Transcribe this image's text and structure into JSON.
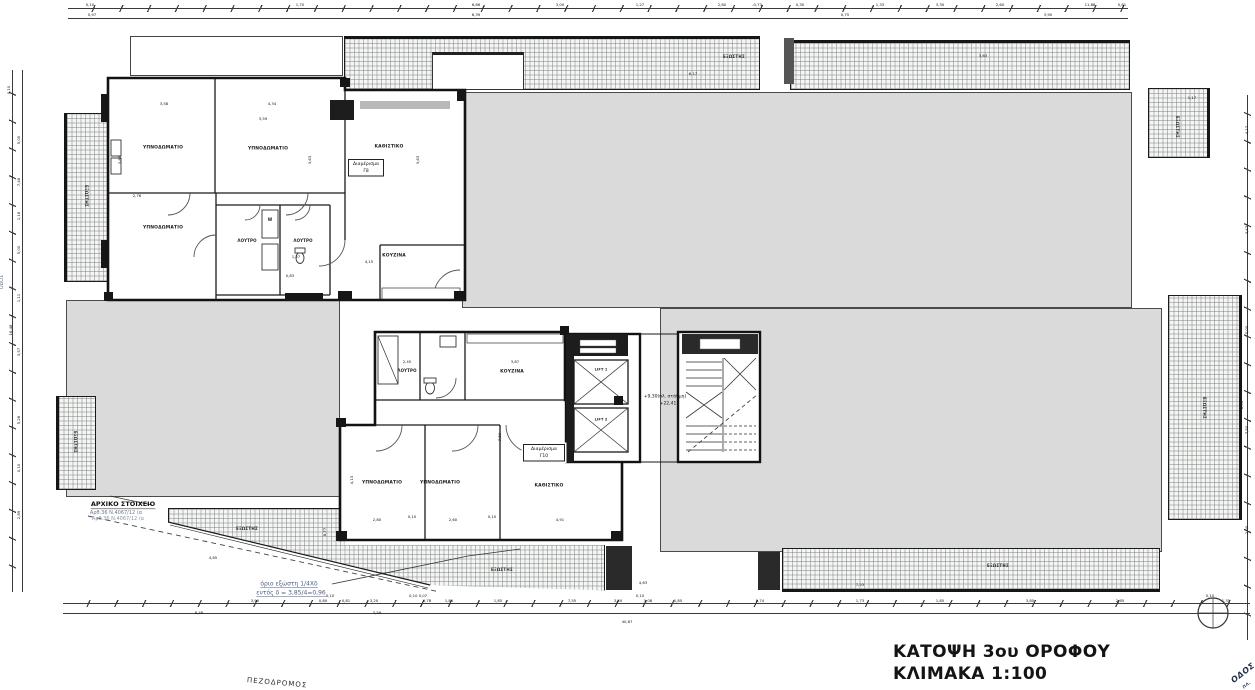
{
  "title": {
    "line1": "ΚΑΤΟΨΗ 3ου ΟΡΟΦΟΥ",
    "line2": "ΚΛΙΜΑΚΑ 1:100"
  },
  "apartment_tags": {
    "g8": {
      "label": "Διαμέρισμα",
      "unit": "Γ8"
    },
    "g10": {
      "label": "Διαμέρισμα",
      "unit": "Γ10"
    }
  },
  "colors": {
    "mass_fill": "#dadada",
    "hatch_line": "#8c9696",
    "note_blue": "#4a5f85",
    "line": "#1a1a1a"
  },
  "labels": [
    {
      "t": "ΥΠΝΟΔΩΜΑΤΙΟ",
      "x": 163,
      "y": 148,
      "s": 4.5,
      "c": "room",
      "n": "room-label-bedroom"
    },
    {
      "t": "ΥΠΝΟΔΩΜΑΤΙΟ",
      "x": 268,
      "y": 149,
      "s": 4.5,
      "c": "room",
      "n": "room-label-bedroom"
    },
    {
      "t": "ΚΑΘΙΣΤΙΚΟ",
      "x": 389,
      "y": 147,
      "s": 4.5,
      "c": "room",
      "n": "room-label-living"
    },
    {
      "t": "ΥΠΝΟΔΩΜΑΤΙΟ",
      "x": 163,
      "y": 228,
      "s": 4.5,
      "c": "room",
      "n": "room-label-bedroom"
    },
    {
      "t": "ΛΟΥΤΡΟ",
      "x": 247,
      "y": 241,
      "s": 4,
      "c": "room",
      "n": "room-label-bath"
    },
    {
      "t": "W",
      "x": 270,
      "y": 220,
      "s": 4,
      "c": "room",
      "n": "room-label-wc"
    },
    {
      "t": "ΛΟΥΤΡΟ",
      "x": 303,
      "y": 241,
      "s": 4,
      "c": "room",
      "n": "room-label-bath"
    },
    {
      "t": "ΚΟΥΖΙΝΑ",
      "x": 394,
      "y": 256,
      "s": 4.5,
      "c": "room",
      "n": "room-label-kitchen"
    },
    {
      "t": "ΛΟΥΤΡΟ",
      "x": 407,
      "y": 371,
      "s": 4,
      "c": "room",
      "n": "room-label-bath"
    },
    {
      "t": "ΚΟΥΖΙΝΑ",
      "x": 512,
      "y": 372,
      "s": 4.5,
      "c": "room",
      "n": "room-label-kitchen"
    },
    {
      "t": "ΥΠΝΟΔΩΜΑΤΙΟ",
      "x": 382,
      "y": 483,
      "s": 4.5,
      "c": "room",
      "n": "room-label-bedroom"
    },
    {
      "t": "ΥΠΝΟΔΩΜΑΤΙΟ",
      "x": 440,
      "y": 483,
      "s": 4.5,
      "c": "room",
      "n": "room-label-bedroom"
    },
    {
      "t": "ΚΑΘΙΣΤΙΚΟ",
      "x": 549,
      "y": 486,
      "s": 4.5,
      "c": "room",
      "n": "room-label-living"
    },
    {
      "t": "LIFT 1",
      "x": 601,
      "y": 370,
      "s": 3.5,
      "c": "room",
      "n": "lift-label"
    },
    {
      "t": "LIFT 2",
      "x": 601,
      "y": 420,
      "s": 3.5,
      "c": "room",
      "n": "lift-label"
    },
    {
      "t": "+9,30(πλ. στάθμη)",
      "x": 665,
      "y": 397,
      "s": 4.5,
      "c": "dim",
      "n": "level-label"
    },
    {
      "t": "+22,41",
      "x": 668,
      "y": 404,
      "s": 4.5,
      "c": "dim",
      "n": "level-label"
    },
    {
      "t": "ΕΞΩΣΤΗΣ",
      "x": 734,
      "y": 57,
      "s": 4,
      "c": "bal-l",
      "n": "balcony-label"
    },
    {
      "t": "ΕΞΩΣΤΗΣ",
      "x": 1177,
      "y": 127,
      "s": 4,
      "r": 90,
      "c": "bal-l",
      "n": "balcony-label"
    },
    {
      "t": "ΕΞΩΣΤΗΣ",
      "x": 1204,
      "y": 408,
      "s": 4,
      "r": 90,
      "c": "bal-l",
      "n": "balcony-label"
    },
    {
      "t": "ΕΞΩΣΤΗΣ",
      "x": 998,
      "y": 566,
      "s": 4,
      "c": "bal-l",
      "n": "balcony-label"
    },
    {
      "t": "ΕΞΩΣΤΗΣ",
      "x": 502,
      "y": 570,
      "s": 4,
      "c": "bal-l",
      "n": "balcony-label"
    },
    {
      "t": "ΕΞΩΣΤΗΣ",
      "x": 247,
      "y": 529,
      "s": 4,
      "c": "bal-l",
      "n": "balcony-label"
    },
    {
      "t": "ΕΞΩΣΤΗΣ",
      "x": 86,
      "y": 196,
      "s": 4,
      "r": 90,
      "c": "bal-l",
      "n": "balcony-label"
    },
    {
      "t": "ΕΞΩΣΤΗΣ",
      "x": 75,
      "y": 442,
      "s": 4,
      "r": 90,
      "c": "bal-l",
      "n": "balcony-label"
    },
    {
      "t": "ΑΡΧΙΚΟ ΣΤΟΙΧΕΙΟ",
      "x": 123,
      "y": 505,
      "s": 6.5,
      "c": "note-strong",
      "n": "note-initial-element"
    },
    {
      "t": "Αρθ.36 Ν.4067/12 (α",
      "x": 116,
      "y": 513,
      "s": 5,
      "c": "note-gray",
      "n": "note-regulation"
    },
    {
      "t": "Αρθ.36 Ν.4067/12 (α",
      "x": 118,
      "y": 519,
      "s": 5,
      "c": "note-gray2",
      "n": "note-regulation"
    },
    {
      "t": "όριο εξώστη 1/4Χδ",
      "x": 289,
      "y": 584,
      "s": 6,
      "c": "note-blue",
      "n": "note-balcony-limit"
    },
    {
      "t": "εντός δ = 3,85/4=0,96",
      "x": 291,
      "y": 593,
      "s": 6,
      "c": "note-blue",
      "n": "note-balcony-limit"
    },
    {
      "t": "ΠΕΖΟΔΡΟΜΟΣ",
      "x": 277,
      "y": 683,
      "s": 7,
      "r": 5,
      "c": "street",
      "n": "street-label-pedestrian"
    },
    {
      "t": "ΟΔΟΣ",
      "x": 1243,
      "y": 673,
      "s": 8,
      "r": -38,
      "c": "street-diag",
      "n": "street-label-road"
    },
    {
      "t": "ΠΛ.",
      "x": 1247,
      "y": 685,
      "s": 4,
      "r": -38,
      "c": "street-diag",
      "n": "street-label-road"
    },
    {
      "t": "ΟΔΟΣ",
      "x": 2,
      "y": 282,
      "s": 5,
      "r": -90,
      "c": "note-gray",
      "n": "street-label-side"
    },
    {
      "t": "0,10",
      "x": 90,
      "y": 5,
      "s": 3.8,
      "c": "dim",
      "n": "dim"
    },
    {
      "t": "1,70",
      "x": 300,
      "y": 5,
      "s": 3.8,
      "c": "dim",
      "n": "dim"
    },
    {
      "t": "6,86",
      "x": 476,
      "y": 5,
      "s": 3.8,
      "c": "dim",
      "n": "dim"
    },
    {
      "t": "3,00",
      "x": 560,
      "y": 5,
      "s": 3.8,
      "c": "dim",
      "n": "dim"
    },
    {
      "t": "1,27",
      "x": 640,
      "y": 5,
      "s": 3.8,
      "c": "dim",
      "n": "dim"
    },
    {
      "t": "2,60",
      "x": 722,
      "y": 5,
      "s": 3.8,
      "c": "dim",
      "n": "dim"
    },
    {
      "t": "-0,73",
      "x": 757,
      "y": 5,
      "s": 3.8,
      "c": "dim",
      "n": "dim"
    },
    {
      "t": "0,30",
      "x": 800,
      "y": 5,
      "s": 3.8,
      "c": "dim",
      "n": "dim"
    },
    {
      "t": "1,33",
      "x": 880,
      "y": 5,
      "s": 3.8,
      "c": "dim",
      "n": "dim"
    },
    {
      "t": "3,30",
      "x": 940,
      "y": 5,
      "s": 3.8,
      "c": "dim",
      "n": "dim"
    },
    {
      "t": "2,60",
      "x": 1000,
      "y": 5,
      "s": 3.8,
      "c": "dim",
      "n": "dim"
    },
    {
      "t": "11,88",
      "x": 1090,
      "y": 5,
      "s": 3.8,
      "c": "dim",
      "n": "dim"
    },
    {
      "t": "0,81",
      "x": 1122,
      "y": 5,
      "s": 3.8,
      "c": "dim",
      "n": "dim"
    },
    {
      "t": "0,97",
      "x": 92,
      "y": 15,
      "s": 3.8,
      "c": "dim",
      "n": "dim"
    },
    {
      "t": "6,39",
      "x": 476,
      "y": 15,
      "s": 3.8,
      "c": "dim",
      "n": "dim"
    },
    {
      "t": "0,75",
      "x": 845,
      "y": 15,
      "s": 3.8,
      "c": "dim",
      "n": "dim"
    },
    {
      "t": "3,90",
      "x": 1048,
      "y": 15,
      "s": 3.8,
      "c": "dim",
      "n": "dim"
    },
    {
      "t": "0,10",
      "x": 9,
      "y": 90,
      "s": 3.8,
      "r": -90,
      "c": "dim",
      "n": "dim"
    },
    {
      "t": "5,00",
      "x": 19,
      "y": 140,
      "s": 3.8,
      "r": -90,
      "c": "dim",
      "n": "dim"
    },
    {
      "t": "7,48",
      "x": 19,
      "y": 182,
      "s": 3.8,
      "r": -90,
      "c": "dim",
      "n": "dim"
    },
    {
      "t": "1,18",
      "x": 19,
      "y": 216,
      "s": 3.8,
      "r": -90,
      "c": "dim",
      "n": "dim"
    },
    {
      "t": "5,00",
      "x": 19,
      "y": 250,
      "s": 3.8,
      "r": -90,
      "c": "dim",
      "n": "dim"
    },
    {
      "t": "1,11",
      "x": 19,
      "y": 298,
      "s": 3.8,
      "r": -90,
      "c": "dim",
      "n": "dim"
    },
    {
      "t": "16,48",
      "x": 11,
      "y": 330,
      "s": 3.8,
      "r": -90,
      "c": "dim",
      "n": "dim"
    },
    {
      "t": "3,57",
      "x": 19,
      "y": 352,
      "s": 3.8,
      "r": -90,
      "c": "dim",
      "n": "dim"
    },
    {
      "t": "5,28",
      "x": 19,
      "y": 420,
      "s": 3.8,
      "r": -90,
      "c": "dim",
      "n": "dim"
    },
    {
      "t": "0,10",
      "x": 19,
      "y": 468,
      "s": 3.8,
      "r": -90,
      "c": "dim",
      "n": "dim"
    },
    {
      "t": "2,89",
      "x": 19,
      "y": 515,
      "s": 3.8,
      "r": -90,
      "c": "dim",
      "n": "dim"
    },
    {
      "t": "1,17",
      "x": 1192,
      "y": 98,
      "s": 3.8,
      "c": "dim",
      "n": "dim"
    },
    {
      "t": "4,17",
      "x": 1247,
      "y": 130,
      "s": 3.8,
      "r": -90,
      "c": "dim",
      "n": "dim"
    },
    {
      "t": "3,47",
      "x": 1247,
      "y": 230,
      "s": 3.8,
      "r": -90,
      "c": "dim",
      "n": "dim"
    },
    {
      "t": "5,00",
      "x": 1247,
      "y": 330,
      "s": 3.8,
      "r": -90,
      "c": "dim",
      "n": "dim"
    },
    {
      "t": "7,50",
      "x": 1247,
      "y": 430,
      "s": 3.8,
      "r": -90,
      "c": "dim",
      "n": "dim"
    },
    {
      "t": "2,30",
      "x": 1247,
      "y": 530,
      "s": 3.8,
      "r": -90,
      "c": "dim",
      "n": "dim"
    },
    {
      "t": "8,05",
      "x": 1242,
      "y": 405,
      "s": 3.8,
      "r": -90,
      "c": "dim",
      "n": "dim"
    },
    {
      "t": "3,90",
      "x": 255,
      "y": 601,
      "s": 3.8,
      "c": "dim",
      "n": "dim"
    },
    {
      "t": "0,80",
      "x": 323,
      "y": 601,
      "s": 3.8,
      "c": "dim",
      "n": "dim"
    },
    {
      "t": "0,81",
      "x": 346,
      "y": 601,
      "s": 3.8,
      "c": "dim",
      "n": "dim"
    },
    {
      "t": "3,20",
      "x": 374,
      "y": 601,
      "s": 3.8,
      "c": "dim",
      "n": "dim"
    },
    {
      "t": "0,78",
      "x": 427,
      "y": 601,
      "s": 3.8,
      "c": "dim",
      "n": "dim"
    },
    {
      "t": "1,80",
      "x": 449,
      "y": 601,
      "s": 3.8,
      "c": "dim",
      "n": "dim"
    },
    {
      "t": "1,85",
      "x": 498,
      "y": 601,
      "s": 3.8,
      "c": "dim",
      "n": "dim"
    },
    {
      "t": "7,55",
      "x": 572,
      "y": 601,
      "s": 3.8,
      "c": "dim",
      "n": "dim"
    },
    {
      "t": "3,20",
      "x": 618,
      "y": 601,
      "s": 3.8,
      "c": "dim",
      "n": "dim"
    },
    {
      "t": "1,08",
      "x": 648,
      "y": 601,
      "s": 3.8,
      "c": "dim",
      "n": "dim"
    },
    {
      "t": "1,85",
      "x": 678,
      "y": 601,
      "s": 3.8,
      "c": "dim",
      "n": "dim"
    },
    {
      "t": "5,74",
      "x": 760,
      "y": 601,
      "s": 3.8,
      "c": "dim",
      "n": "dim"
    },
    {
      "t": "1,73",
      "x": 860,
      "y": 601,
      "s": 3.8,
      "c": "dim",
      "n": "dim"
    },
    {
      "t": "1,85",
      "x": 940,
      "y": 601,
      "s": 3.8,
      "c": "dim",
      "n": "dim"
    },
    {
      "t": "3,85",
      "x": 1030,
      "y": 601,
      "s": 3.8,
      "c": "dim",
      "n": "dim"
    },
    {
      "t": "2,85",
      "x": 1120,
      "y": 601,
      "s": 3.8,
      "c": "dim",
      "n": "dim"
    },
    {
      "t": "1,35",
      "x": 1226,
      "y": 601,
      "s": 3.8,
      "c": "dim",
      "n": "dim"
    },
    {
      "t": "0,10",
      "x": 330,
      "y": 596,
      "s": 3.8,
      "c": "dim",
      "n": "dim"
    },
    {
      "t": "0,10 0,07",
      "x": 418,
      "y": 596,
      "s": 3.8,
      "c": "dim",
      "n": "dim"
    },
    {
      "t": "0,10",
      "x": 640,
      "y": 596,
      "s": 3.8,
      "c": "dim",
      "n": "dim"
    },
    {
      "t": "0,10",
      "x": 1210,
      "y": 596,
      "s": 3.8,
      "c": "dim",
      "n": "dim"
    },
    {
      "t": "8,48",
      "x": 199,
      "y": 613,
      "s": 3.8,
      "c": "dim",
      "n": "dim"
    },
    {
      "t": "3,59",
      "x": 377,
      "y": 613,
      "s": 3.8,
      "c": "dim",
      "n": "dim"
    },
    {
      "t": "40,87",
      "x": 627,
      "y": 622,
      "s": 3.8,
      "c": "dim",
      "n": "dim"
    },
    {
      "t": "3,58",
      "x": 164,
      "y": 104,
      "s": 3.8,
      "c": "dim",
      "n": "dim"
    },
    {
      "t": "4,34",
      "x": 272,
      "y": 104,
      "s": 3.8,
      "c": "dim",
      "n": "dim"
    },
    {
      "t": "3,59",
      "x": 263,
      "y": 119,
      "s": 3.8,
      "c": "dim",
      "n": "dim"
    },
    {
      "t": "3,83",
      "x": 120,
      "y": 160,
      "s": 3.8,
      "r": -90,
      "c": "dim",
      "n": "dim"
    },
    {
      "t": "3,63",
      "x": 310,
      "y": 160,
      "s": 3.8,
      "r": -90,
      "c": "dim",
      "n": "dim"
    },
    {
      "t": "3,63",
      "x": 418,
      "y": 160,
      "s": 3.8,
      "r": -90,
      "c": "dim",
      "n": "dim"
    },
    {
      "t": "2,76",
      "x": 137,
      "y": 196,
      "s": 3.8,
      "c": "dim",
      "n": "dim"
    },
    {
      "t": "4,15",
      "x": 369,
      "y": 262,
      "s": 3.8,
      "c": "dim",
      "n": "dim"
    },
    {
      "t": "1,27",
      "x": 296,
      "y": 257,
      "s": 3.8,
      "c": "dim",
      "n": "dim"
    },
    {
      "t": "0,83",
      "x": 290,
      "y": 276,
      "s": 3.8,
      "c": "dim",
      "n": "dim"
    },
    {
      "t": "3,87",
      "x": 515,
      "y": 362,
      "s": 3.8,
      "c": "dim",
      "n": "dim"
    },
    {
      "t": "2,45",
      "x": 407,
      "y": 362,
      "s": 3.8,
      "c": "dim",
      "n": "dim"
    },
    {
      "t": "7,50",
      "x": 500,
      "y": 437,
      "s": 3.8,
      "r": -90,
      "c": "dim",
      "n": "dim"
    },
    {
      "t": "2,80",
      "x": 377,
      "y": 520,
      "s": 3.8,
      "c": "dim",
      "n": "dim"
    },
    {
      "t": "0,10",
      "x": 412,
      "y": 517,
      "s": 3.8,
      "c": "dim",
      "n": "dim"
    },
    {
      "t": "2,60",
      "x": 453,
      "y": 520,
      "s": 3.8,
      "c": "dim",
      "n": "dim"
    },
    {
      "t": "0,10",
      "x": 492,
      "y": 517,
      "s": 3.8,
      "c": "dim",
      "n": "dim"
    },
    {
      "t": "4,91",
      "x": 560,
      "y": 520,
      "s": 3.8,
      "c": "dim",
      "n": "dim"
    },
    {
      "t": "4,13",
      "x": 352,
      "y": 480,
      "s": 3.8,
      "r": -90,
      "c": "dim",
      "n": "dim"
    },
    {
      "t": "6,17",
      "x": 693,
      "y": 74,
      "s": 3.8,
      "c": "dim",
      "n": "dim"
    },
    {
      "t": "3,63",
      "x": 983,
      "y": 56,
      "s": 3.8,
      "c": "dim",
      "n": "dim"
    },
    {
      "t": "4,63",
      "x": 643,
      "y": 583,
      "s": 3.8,
      "c": "dim",
      "n": "dim"
    },
    {
      "t": "4,65",
      "x": 213,
      "y": 558,
      "s": 3.8,
      "c": "dim",
      "n": "dim"
    },
    {
      "t": "7,53",
      "x": 860,
      "y": 585,
      "s": 3.8,
      "c": "dim",
      "n": "dim"
    },
    {
      "t": "8,77",
      "x": 325,
      "y": 532,
      "s": 3.8,
      "r": -90,
      "c": "dim",
      "n": "dim"
    }
  ]
}
